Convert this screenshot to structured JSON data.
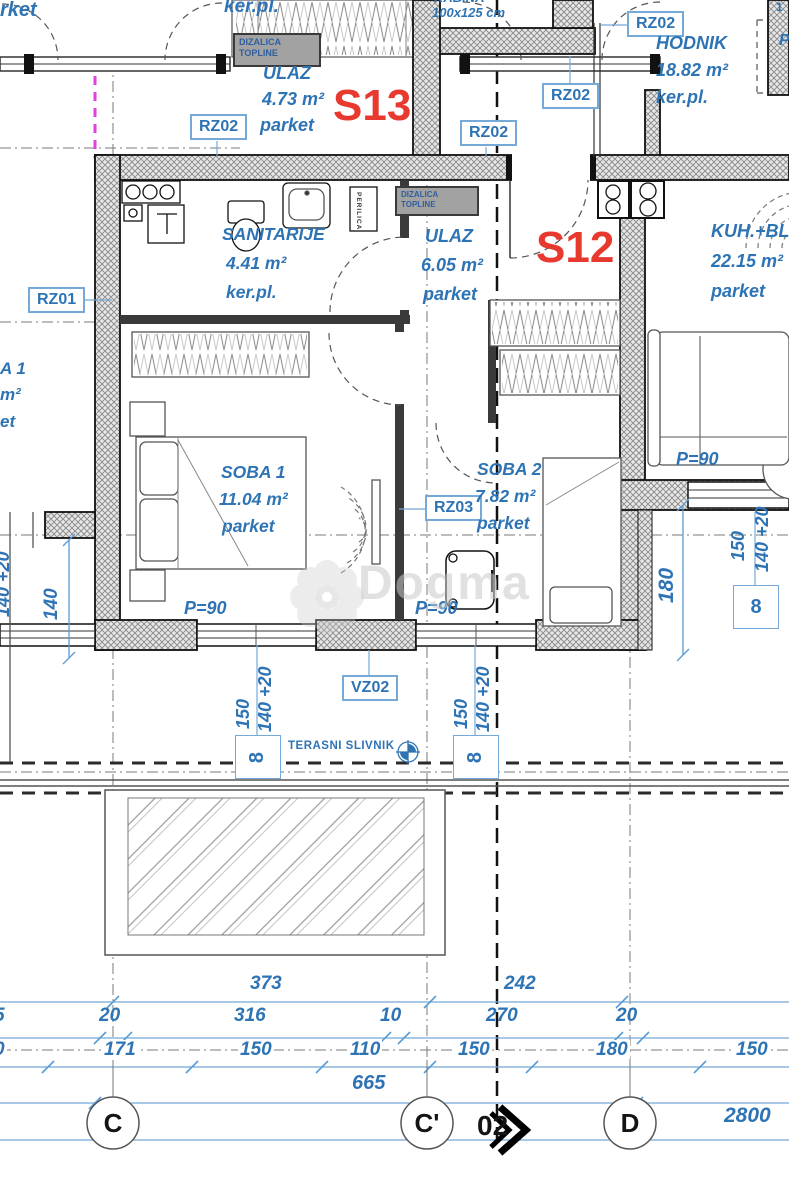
{
  "watermark": "Dogma",
  "units": {
    "s13": "S13",
    "s12": "S12"
  },
  "rooms": {
    "ulaz_s13": {
      "name": "ULAZ",
      "area": "4.73 m²",
      "floor": "parket"
    },
    "kabina": {
      "name": "KABINA",
      "size": "100x125 cm"
    },
    "hodnik": {
      "name": "HODNIK",
      "area": "18.82 m²",
      "floor": "ker.pl."
    },
    "sanitarije": {
      "name": "SANITARIJE",
      "area": "4.41 m²",
      "floor": "ker.pl."
    },
    "ulaz_s12": {
      "name": "ULAZ",
      "area": "6.05 m²",
      "floor": "parket"
    },
    "kuh": {
      "name": "KUH.+BL",
      "area": "22.15 m²",
      "floor": "parket"
    },
    "soba1": {
      "name": "SOBA 1",
      "area": "11.04 m²",
      "floor": "parket"
    },
    "soba2": {
      "name": "SOBA 2",
      "area": "7.82 m²",
      "floor": "parket"
    }
  },
  "labels": {
    "rz01": "RZ01",
    "rz02": "RZ02",
    "rz03": "RZ03",
    "vz02": "VZ02",
    "p90": "P=90",
    "dizalica_line1": "DIZALICA",
    "dizalica_line2": "TOPLINE",
    "perilica": "PERILICA",
    "terasni_slivnik": "TERASNI SLIVNIK",
    "shaft": "8"
  },
  "partials": {
    "parket_top": "rket",
    "kerpl_top": "ker.pl.",
    "left_soba": "A 1",
    "left_m2": "m²",
    "left_parket": "et",
    "right_p": "P",
    "right_1": "1",
    "dim_left_5": "5",
    "dim_left_0": "0"
  },
  "dims": {
    "row1": [
      "373",
      "242"
    ],
    "row2": [
      "20",
      "316",
      "10",
      "270",
      "20"
    ],
    "row3": [
      "171",
      "150",
      "110",
      "150",
      "180",
      "150"
    ],
    "total_665": "665",
    "total_2800": "2800",
    "v140": "140",
    "v140_20": "140 +20",
    "v150": "150",
    "v180": "180"
  },
  "grid": {
    "c": "C",
    "c_prime": "C'",
    "d": "D",
    "section": "02"
  },
  "colors": {
    "text_blue": "#2e74b5",
    "dim_blue": "#5b9bd5",
    "unit_red": "#e8392f",
    "boundary_magenta": "#e33fe3"
  }
}
